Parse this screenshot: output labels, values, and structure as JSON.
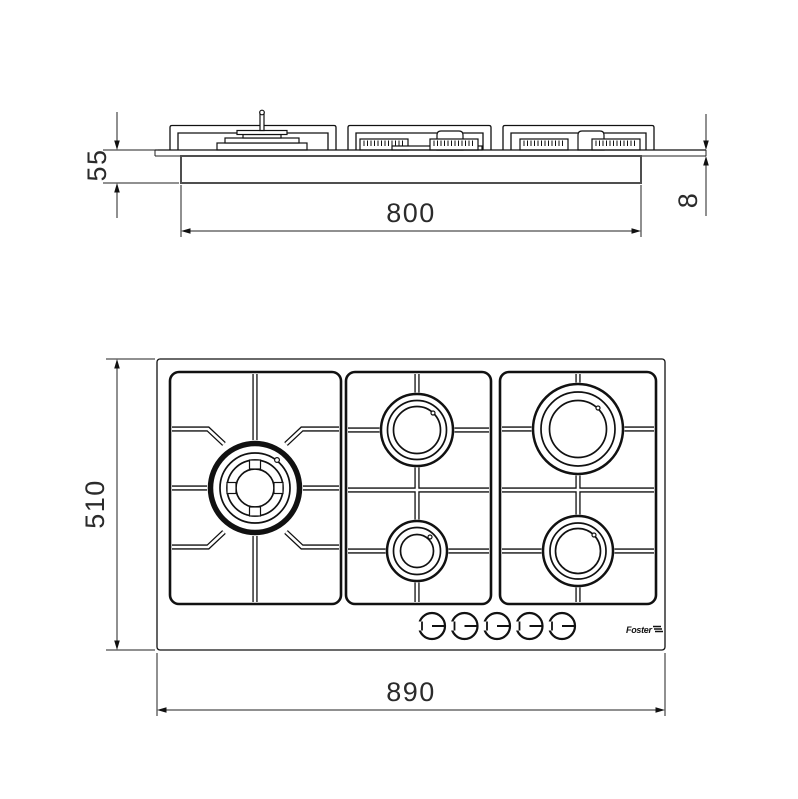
{
  "brand": "Foster",
  "side_view": {
    "height_label": "55",
    "cutout_width_label": "800",
    "plate_thickness_label": "8"
  },
  "plan_view": {
    "depth_label": "510",
    "width_label": "890"
  }
}
